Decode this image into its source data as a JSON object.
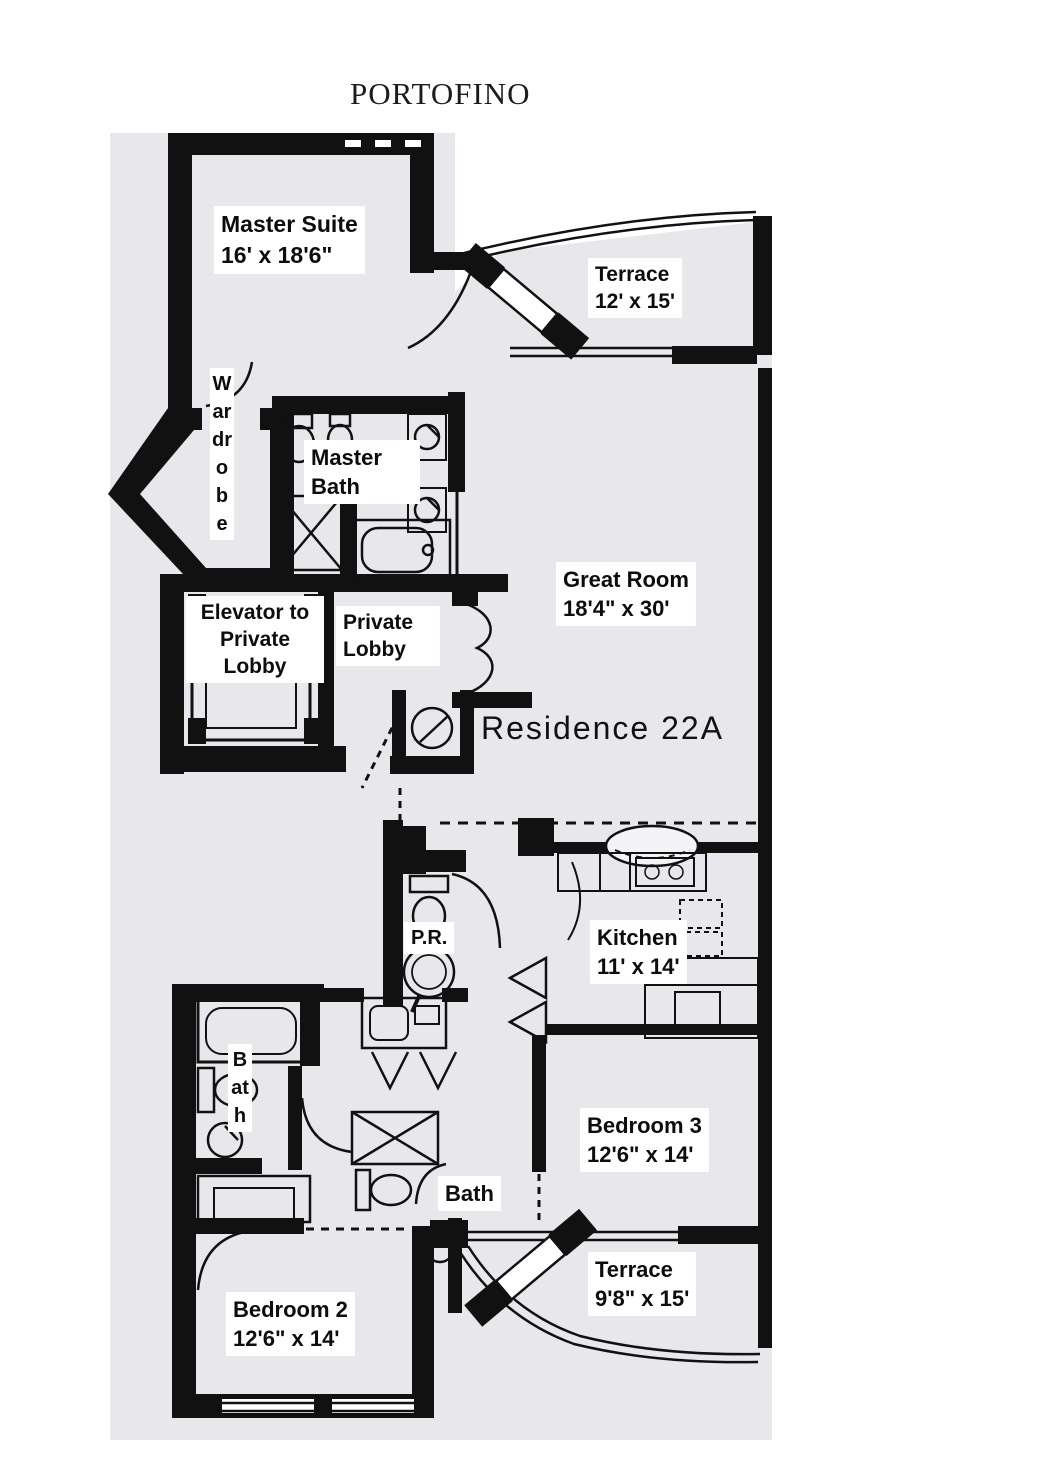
{
  "title": "PORTOFINO",
  "residence_label": "Residence 22A",
  "rooms": {
    "master_suite": {
      "name": "Master Suite",
      "dims": "16' x 18'6\""
    },
    "terrace_top": {
      "name": "Terrace",
      "dims": "12' x 15'"
    },
    "wardrobe": {
      "name": "Wardrobe"
    },
    "master_bath": {
      "name": "Master Bath"
    },
    "elevator": {
      "name": "Elevator to Private Lobby"
    },
    "private_lobby": {
      "name": "Private Lobby"
    },
    "great_room": {
      "name": "Great Room",
      "dims": "18'4\" x 30'"
    },
    "powder_room": {
      "name": "P.R."
    },
    "kitchen": {
      "name": "Kitchen",
      "dims": "11' x 14'"
    },
    "bath_left": {
      "name": "Bath"
    },
    "bath_center": {
      "name": "Bath"
    },
    "bedroom_3": {
      "name": "Bedroom 3",
      "dims": "12'6\" x 14'"
    },
    "terrace_bottom": {
      "name": "Terrace",
      "dims": "9'8\" x 15'"
    },
    "bedroom_2": {
      "name": "Bedroom 2",
      "dims": "12'6\" x 14'"
    }
  },
  "fixtures": [
    "toilet-icon",
    "bidet-icon",
    "pedestal-sink-icon",
    "vanity-sink-icon",
    "bathtub-icon",
    "shower-icon",
    "elevator-car-icon",
    "water-heater-icon",
    "kitchen-sink-icon",
    "stove-icon",
    "counter-icon",
    "pantry-icon",
    "closet-door-icon",
    "sliding-glass-door-icon",
    "door-swing-icon",
    "window-icon"
  ],
  "colors": {
    "wall": "#111111",
    "plan_background": "#e8e8ec",
    "label_background": "#ffffff",
    "text": "#0d0d0d"
  }
}
